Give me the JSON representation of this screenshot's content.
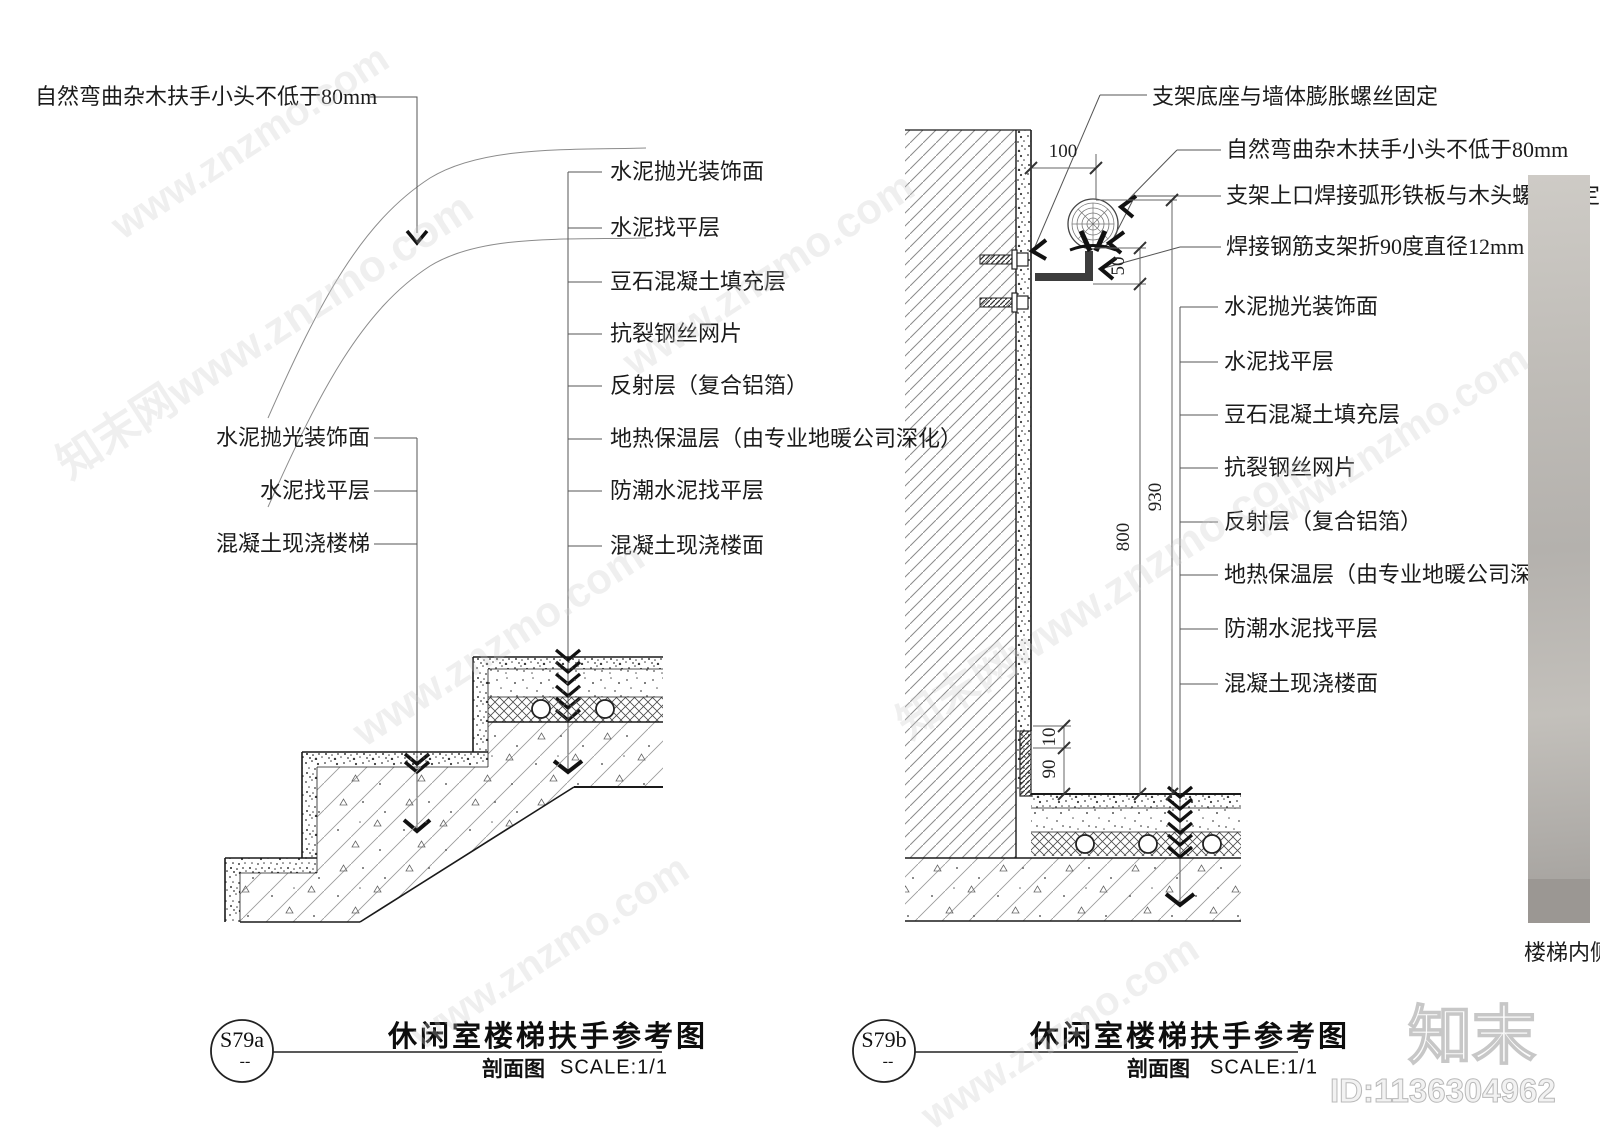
{
  "watermark": {
    "site": "www.znzmo.com",
    "brand": "知末",
    "brand_site": "知末网www.znzmo.com",
    "id_text": "ID:1136304962"
  },
  "photo": {
    "caption": "楼梯内侧"
  },
  "left_panel": {
    "handrail_note": "自然弯曲杂木扶手小头不低于80mm",
    "stair_layers": [
      "水泥抛光装饰面",
      "水泥找平层",
      "混凝土现浇楼梯"
    ],
    "floor_layers": [
      "水泥抛光装饰面",
      "水泥找平层",
      "豆石混凝土填充层",
      "抗裂钢丝网片",
      "反射层（复合铝箔）",
      "地热保温层（由专业地暖公司深化）",
      "防潮水泥找平层",
      "混凝土现浇楼面"
    ],
    "detail_code": "S79a",
    "detail_code_sub": "--",
    "title": "休闲室楼梯扶手参考图",
    "view_type": "剖面图",
    "scale": "SCALE:1/1"
  },
  "right_panel": {
    "notes": [
      "支架底座与墙体膨胀螺丝固定",
      "自然弯曲杂木扶手小头不低于80mm",
      "支架上口焊接弧形铁板与木头螺丝固定",
      "焊接钢筋支架折90度直径12mm"
    ],
    "floor_layers": [
      "水泥抛光装饰面",
      "水泥找平层",
      "豆石混凝土填充层",
      "抗裂钢丝网片",
      "反射层（复合铝箔）",
      "地热保温层（由专业地暖公司深化）",
      "防潮水泥找平层",
      "混凝土现浇楼面"
    ],
    "dims": {
      "offset": "100",
      "drop": "50",
      "rail_bottom_height": "800",
      "rail_top_height": "930",
      "skirt_gap": "10",
      "skirt_height": "90"
    },
    "detail_code": "S79b",
    "detail_code_sub": "--",
    "title": "休闲室楼梯扶手参考图",
    "view_type": "剖面图",
    "scale": "SCALE:1/1"
  }
}
